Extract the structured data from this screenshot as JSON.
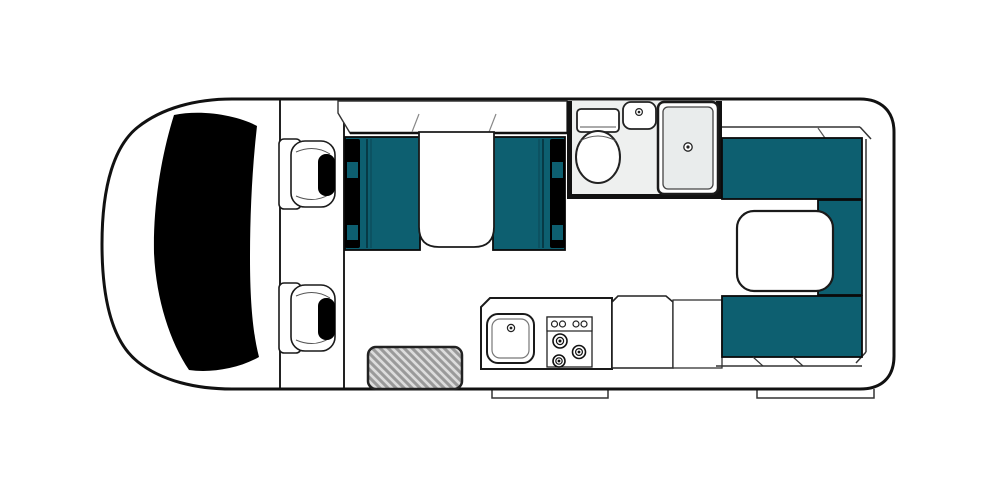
{
  "colors": {
    "upholstery_teal": "#0d5f70",
    "glass_black": "#000000",
    "body_fill": "#ffffff",
    "outline_dark": "#1a1a1a",
    "bathroom_floor": "#eef0ef",
    "shower_tray": "#e9ecec",
    "mat_fill": "#dcdcdc",
    "mat_stripe": "#9a9a9a",
    "background": "#ffffff"
  },
  "floorplan": {
    "vehicle_type": "campervan",
    "view": "top-down",
    "areas": [
      {
        "id": "cab",
        "features": [
          "windshield",
          "driver-seat",
          "passenger-seat"
        ]
      },
      {
        "id": "dinette",
        "features": [
          "overcab-bunk-panel",
          "bench-seat-left",
          "bench-seat-right",
          "table",
          "seatbelt-bars"
        ]
      },
      {
        "id": "bathroom",
        "features": [
          "toilet",
          "hand-basin",
          "shower-tray"
        ]
      },
      {
        "id": "kitchen",
        "features": [
          "sink",
          "stove-4-knobs-3-burners",
          "counter",
          "cabinets"
        ]
      },
      {
        "id": "rear-lounge",
        "features": [
          "u-shaped-seating",
          "table"
        ]
      },
      {
        "id": "entry",
        "features": [
          "door-mat",
          "side-step",
          "rear-step"
        ]
      }
    ]
  }
}
